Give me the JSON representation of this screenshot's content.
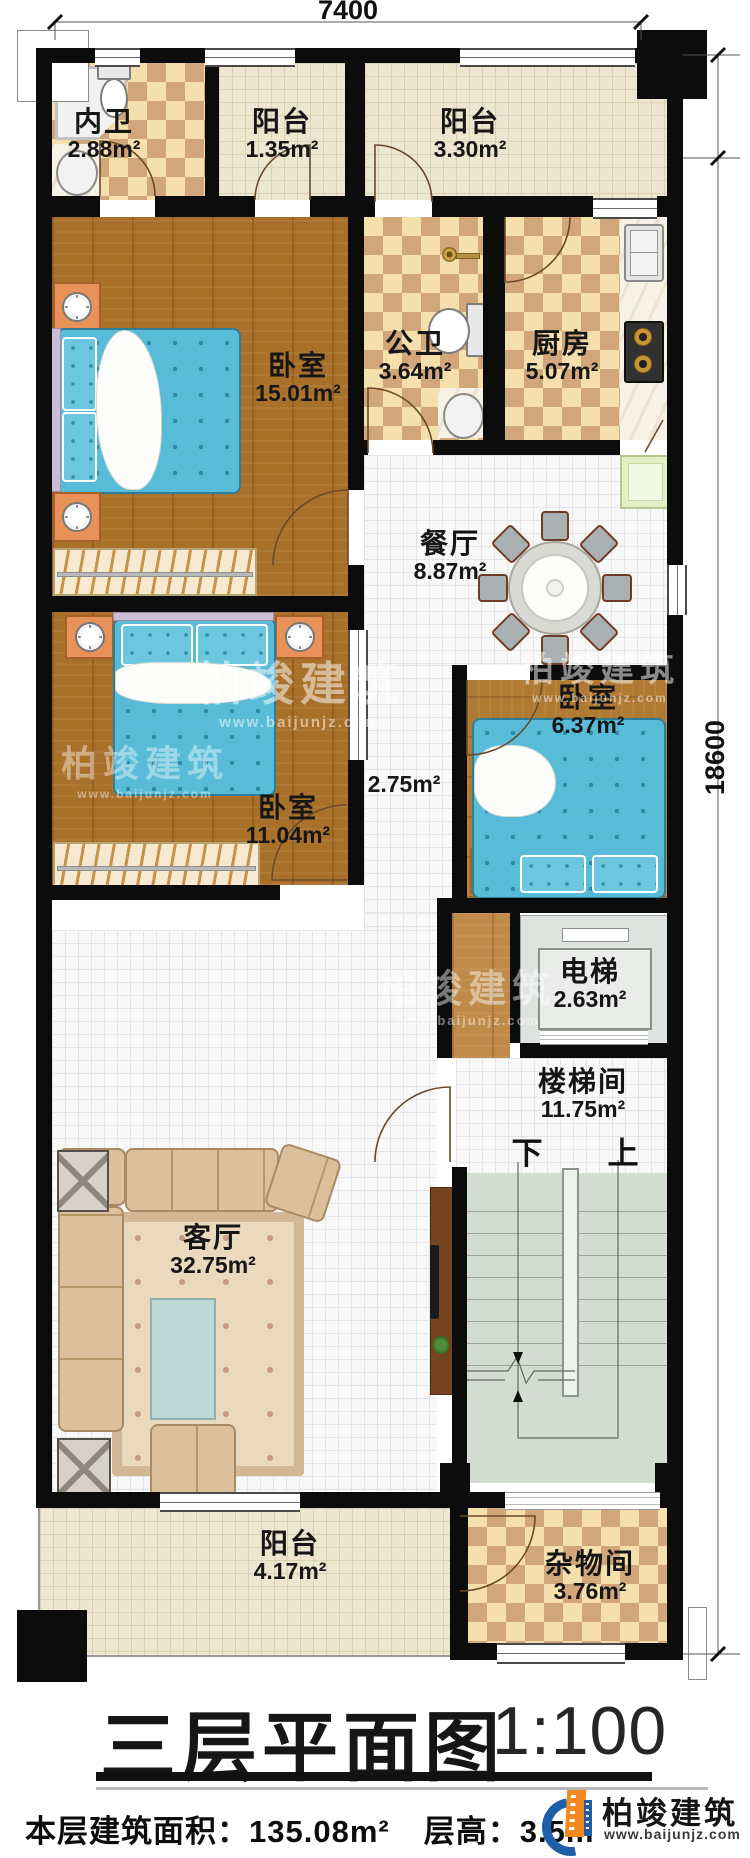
{
  "title_block": {
    "title": "三层平面图",
    "scale": "1:100"
  },
  "footer": {
    "area_label": "本层建筑面积：",
    "area_value": "135.08m²",
    "height_label": "层高：",
    "height_value": "3.5m"
  },
  "dimensions": {
    "top_width": "7400",
    "right_height": "18600"
  },
  "brand": {
    "name": "柏竣建筑",
    "website": "www.baijunjz.com"
  },
  "stair_labels": {
    "down": "下",
    "up": "上"
  },
  "rooms": [
    {
      "id": "ensuite-bath",
      "name": "内卫",
      "area": "2.88m²"
    },
    {
      "id": "balcony-top-left",
      "name": "阳台",
      "area": "1.35m²"
    },
    {
      "id": "balcony-top-right",
      "name": "阳台",
      "area": "3.30m²"
    },
    {
      "id": "bedroom-master",
      "name": "卧室",
      "area": "15.01m²"
    },
    {
      "id": "public-bath",
      "name": "公卫",
      "area": "3.64m²"
    },
    {
      "id": "kitchen",
      "name": "厨房",
      "area": "5.07m²"
    },
    {
      "id": "dining",
      "name": "餐厅",
      "area": "8.87m²"
    },
    {
      "id": "bedroom-right",
      "name": "卧室",
      "area": "6.37m²"
    },
    {
      "id": "corridor",
      "name": "",
      "area": "2.75m²"
    },
    {
      "id": "bedroom-left",
      "name": "卧室",
      "area": "11.04m²"
    },
    {
      "id": "elevator",
      "name": "电梯",
      "area": "2.63m²"
    },
    {
      "id": "living",
      "name": "客厅",
      "area": "32.75m²"
    },
    {
      "id": "stairwell",
      "name": "楼梯间",
      "area": "11.75m²"
    },
    {
      "id": "balcony-bottom",
      "name": "阳台",
      "area": "4.17m²"
    },
    {
      "id": "storage",
      "name": "杂物间",
      "area": "3.76m²"
    }
  ]
}
